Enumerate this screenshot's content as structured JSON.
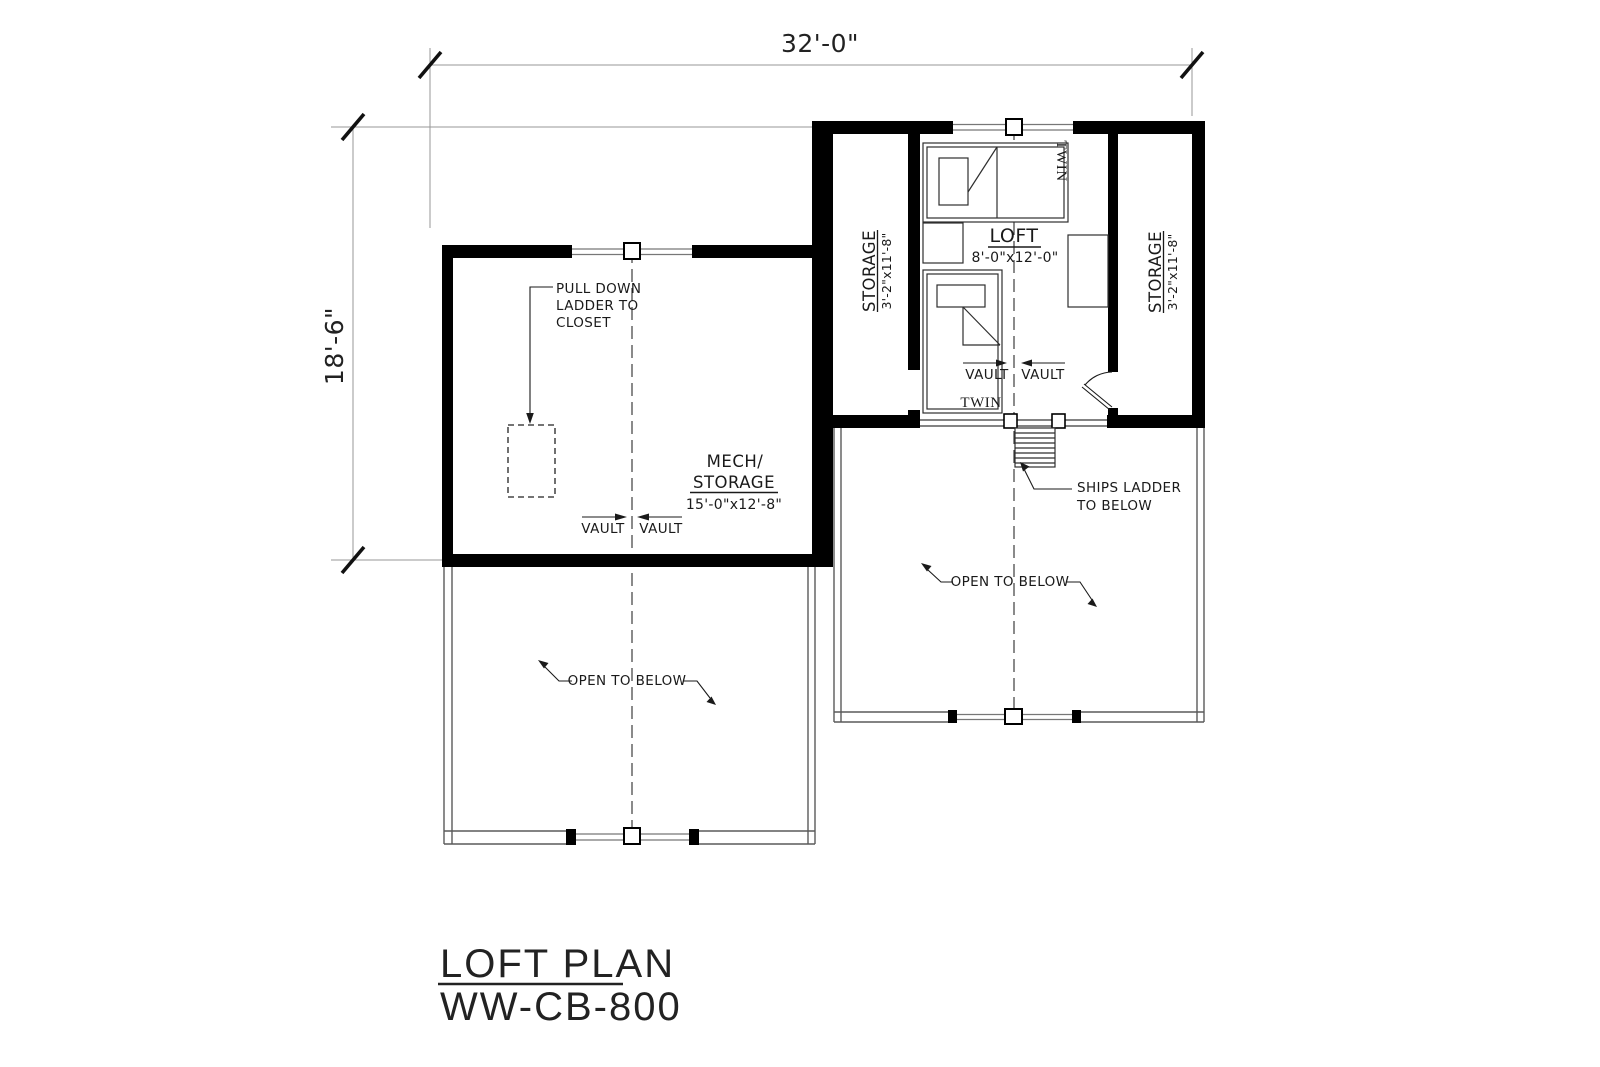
{
  "drawing": {
    "dimensions": {
      "width": "32'-0\"",
      "height": "18'-6\""
    },
    "rooms": {
      "loft": {
        "name": "LOFT",
        "size": "8'-0\"x12'-0\""
      },
      "storage_left": {
        "name": "STORAGE",
        "size": "3'-2\"x11'-8\""
      },
      "storage_right": {
        "name": "STORAGE",
        "size": "3'-2\"x11'-8\""
      },
      "mech": {
        "line1": "MECH/",
        "line2": "STORAGE",
        "size": "15'-0\"x12'-8\""
      }
    },
    "labels": {
      "twin": "TWIN",
      "vault": "VAULT",
      "open_to_below": "OPEN TO BELOW",
      "pull_down": [
        "PULL DOWN",
        "LADDER TO",
        "CLOSET"
      ],
      "ships_ladder": [
        "SHIPS LADDER",
        "TO BELOW"
      ]
    },
    "title": {
      "line1": "LOFT PLAN",
      "line2": "WW-CB-800"
    },
    "colors": {
      "wall": "#000000",
      "thin_line": "#5a5a5a",
      "dim_line": "#979797",
      "text": "#1a1a1a"
    }
  }
}
